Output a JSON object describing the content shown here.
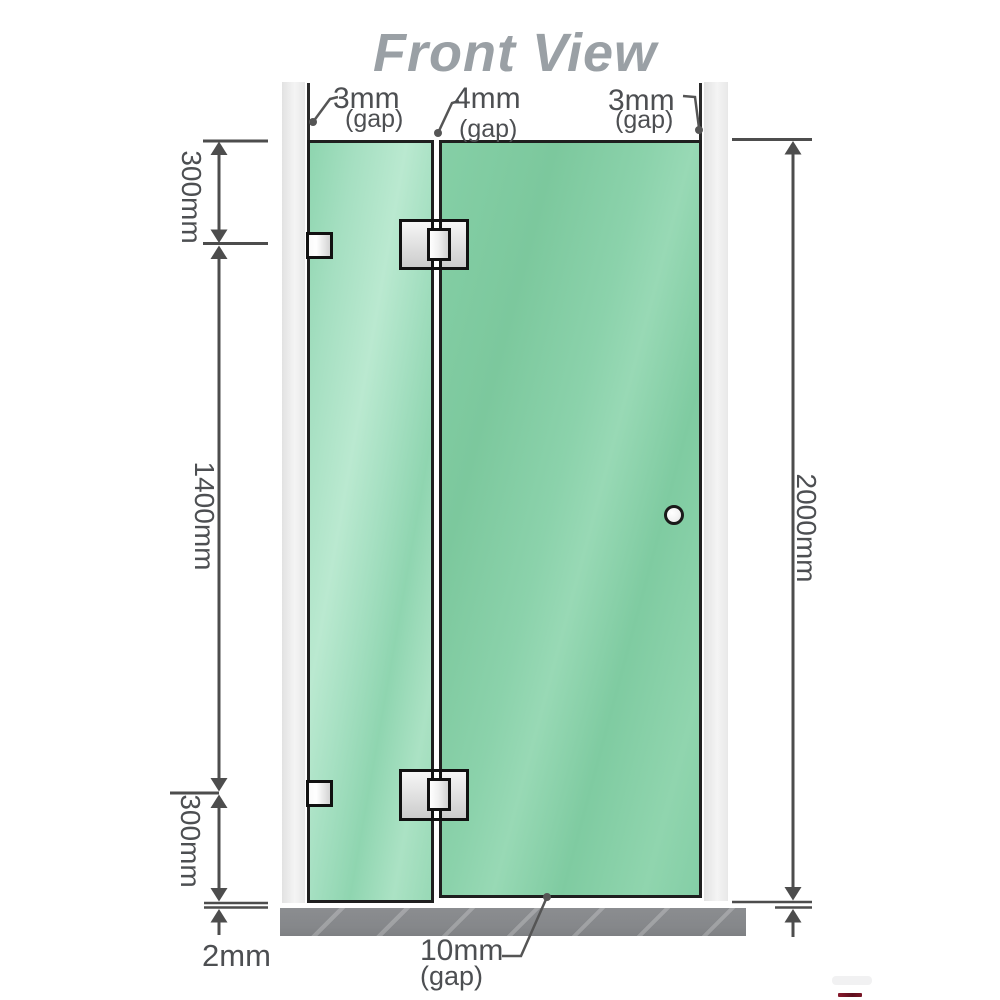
{
  "title": "Front View",
  "colors": {
    "glass_green": "#7dc9a1",
    "glass_highlight": "#b6e9ce",
    "channel_gray": "#ececec",
    "floor_gray": "#87898c",
    "outline_black": "#1f1f1f",
    "dimension_gray": "#4d4f52",
    "title_gray": "#9aa0a5",
    "hardware_metal": "#e8e8e8",
    "logo_red": "#7a1626"
  },
  "annotations": {
    "gap_top_left": {
      "value": "3mm",
      "qualifier": "(gap)"
    },
    "gap_top_middle": {
      "value": "4mm",
      "qualifier": "(gap)"
    },
    "gap_top_right": {
      "value": "3mm",
      "qualifier": "(gap)"
    },
    "segment_top": "300mm",
    "segment_middle": "1400mm",
    "segment_bottom": "300mm",
    "overall_height": "2000mm",
    "floor_clearance": "2mm",
    "door_floor_gap": {
      "value": "10mm",
      "qualifier": "(gap)"
    }
  }
}
